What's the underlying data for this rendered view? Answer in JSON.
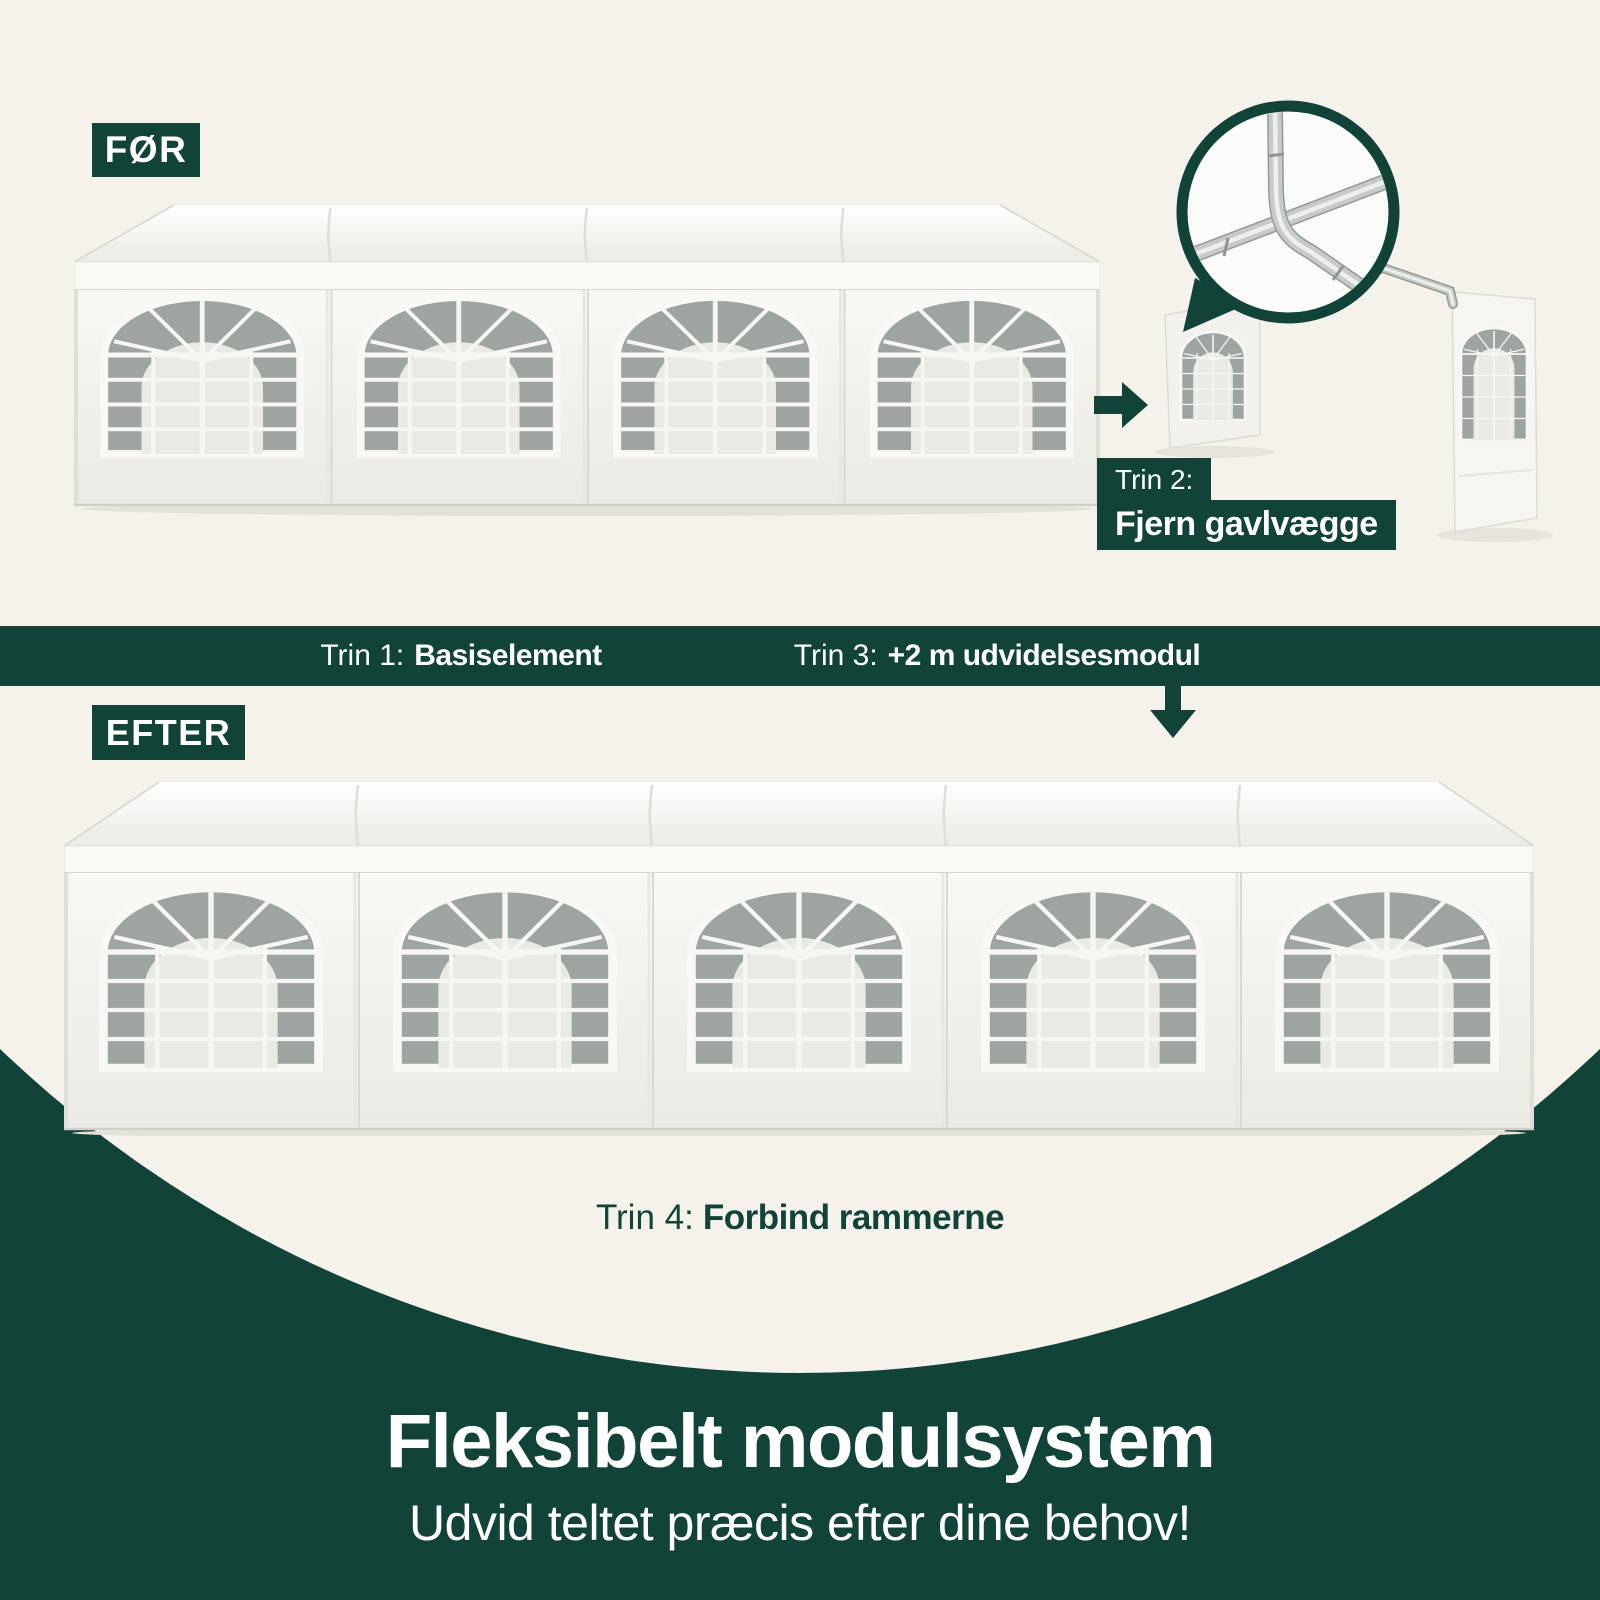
{
  "colors": {
    "green": "#114338",
    "cream": "#F4F2EB",
    "white": "#FFFFFF",
    "tent_white": "#F7F6F2",
    "mesh_gray": "#9EA49F"
  },
  "before": {
    "tag": "FØR",
    "modules": 4
  },
  "after": {
    "tag": "EFTER",
    "modules": 5
  },
  "steps": {
    "step1": {
      "prefix": "Trin 1:",
      "label": "Basiselement"
    },
    "step2": {
      "prefix": "Trin 2:",
      "label": "Fjern gavlvægge"
    },
    "step3": {
      "prefix": "Trin 3:",
      "label": "+2 m udvidelsesmodul"
    },
    "step4": {
      "prefix": "Trin 4:",
      "label": "Forbind rammerne"
    }
  },
  "footer": {
    "title": "Fleksibelt modulsystem",
    "subtitle": "Udvid teltet præcis efter dine behov!"
  },
  "icons": {
    "right_arrow": "solid right-pointing arrow",
    "down_arrow": "solid down-pointing arrow",
    "magnifier": "circular zoom detail of frame joint"
  }
}
